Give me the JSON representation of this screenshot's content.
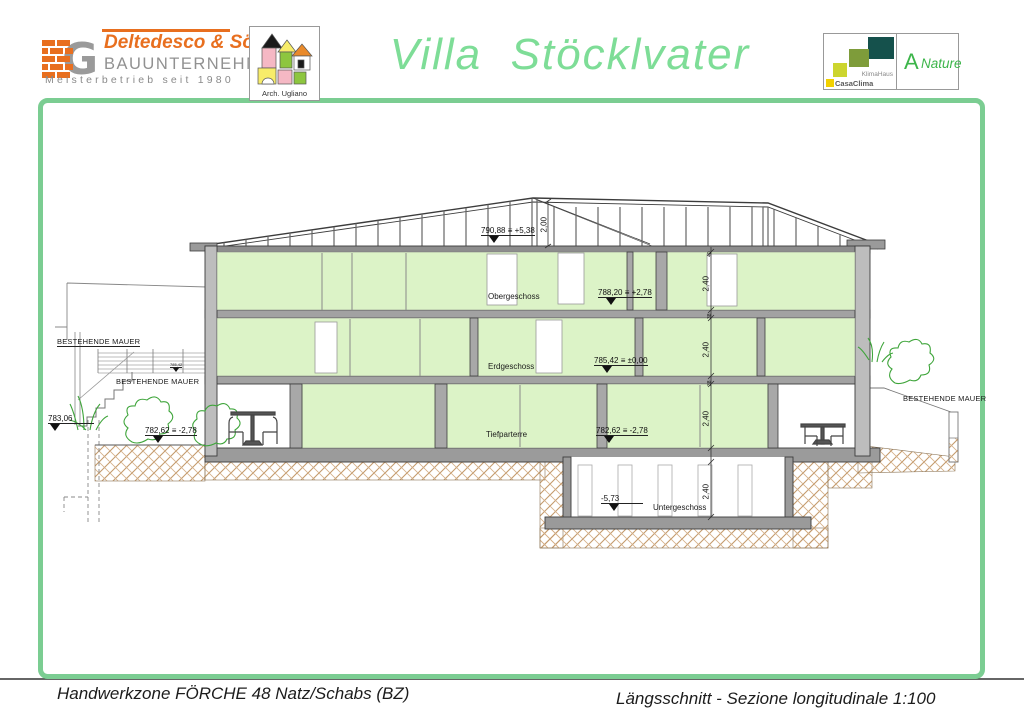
{
  "header": {
    "company": {
      "name": "Deltedesco & Söhne",
      "type": "BAUUNTERNEHMEN",
      "tagline": "Meisterbetrieb seit 1980",
      "monogram": "G"
    },
    "architect": {
      "label": "Arch. Ugliano"
    },
    "title": "Villa  Stöcklvater",
    "certification": {
      "brand_line1": "KlimaHaus",
      "brand_line2": "CasaClima",
      "rating": "A",
      "rating_label": "Nature"
    }
  },
  "footer": {
    "project": "Handwerkzone FÖRCHE 48 Natz/Schabs (BZ)",
    "sheet": "Längsschnitt - Sezione longitudinale  1:100"
  },
  "drawing": {
    "floor_labels": [
      "Obergeschoss",
      "Erdgeschoss",
      "Tiefparterre",
      "Untergeschoss"
    ],
    "elevation_markers": [
      {
        "id": "eaves",
        "text": "790,88 ≡ +5,38"
      },
      {
        "id": "upper-floor",
        "text": "788,20 ≡ +2,78"
      },
      {
        "id": "ground-floor",
        "text": "785,42 ≡ ±0,00"
      },
      {
        "id": "lower-floor",
        "text": "782,62 ≡ -2,78"
      },
      {
        "id": "basement",
        "text": "-5,73"
      },
      {
        "id": "site-left",
        "text": "783,06"
      },
      {
        "id": "terrace-left",
        "text": "782,62 ≡ -2,78"
      },
      {
        "id": "wall-small",
        "text": "785,42"
      }
    ],
    "wall_labels": [
      "BESTEHENDE MAUER",
      "BESTEHENDE MAUER",
      "BESTEHENDE MAUER"
    ],
    "dimensions": {
      "ridge_height": "2,00",
      "storey_height": "2,40",
      "slab_top": "40",
      "slab": "38"
    },
    "colors": {
      "frame_green": "#7bcd92",
      "title_green": "#7edd97",
      "room_green": "#dcf3c7",
      "structure_grey": "#9a9a9a",
      "earth_tan": "#c49a6c",
      "logo_orange": "#e86f1f",
      "cert_teal": "#15514c",
      "cert_olive": "#7e9c3a",
      "cert_lime": "#ccd52e",
      "cert_yellow": "#f2d100",
      "nature_green": "#3cb54a"
    }
  }
}
